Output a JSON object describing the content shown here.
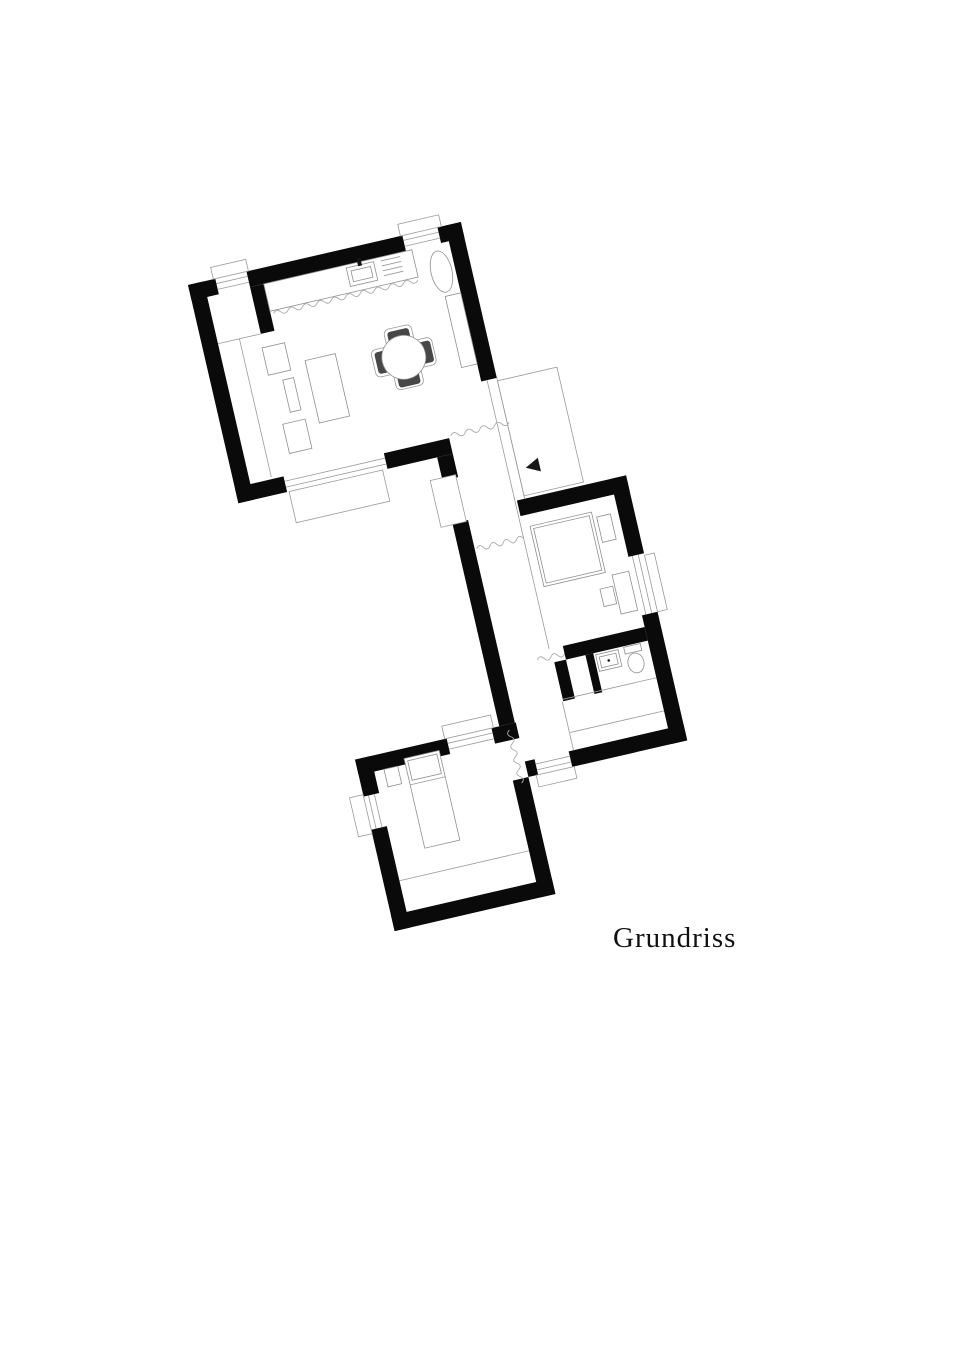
{
  "title": "Grundriss",
  "drawing": {
    "type": "architectural-floor-plan",
    "rotation_deg": -13,
    "colors": {
      "background": "#ffffff",
      "walls": "#0a0a0a",
      "thin_lines": "#9a9a9a",
      "chair_fill": "#474747"
    },
    "rooms": [
      "living-room-with-kitchen",
      "entry-vestibule",
      "corridor",
      "entrance-terrace",
      "bedroom",
      "bathroom",
      "bedroom-2"
    ],
    "furniture": [
      "kitchen-counter",
      "kitchen-sink",
      "cooktop",
      "oval-basin",
      "dining-table",
      "dining-chairs",
      "armchair",
      "coffee-table",
      "sofa",
      "armchair-2",
      "sideboard",
      "double-bed",
      "nightstand",
      "desk",
      "desk-chair",
      "washbasin",
      "toilet",
      "shower",
      "single-bed",
      "nightstand-2"
    ],
    "symbols": [
      "entrance-arrow",
      "door-leaf",
      "window-glazing",
      "break-line"
    ]
  }
}
